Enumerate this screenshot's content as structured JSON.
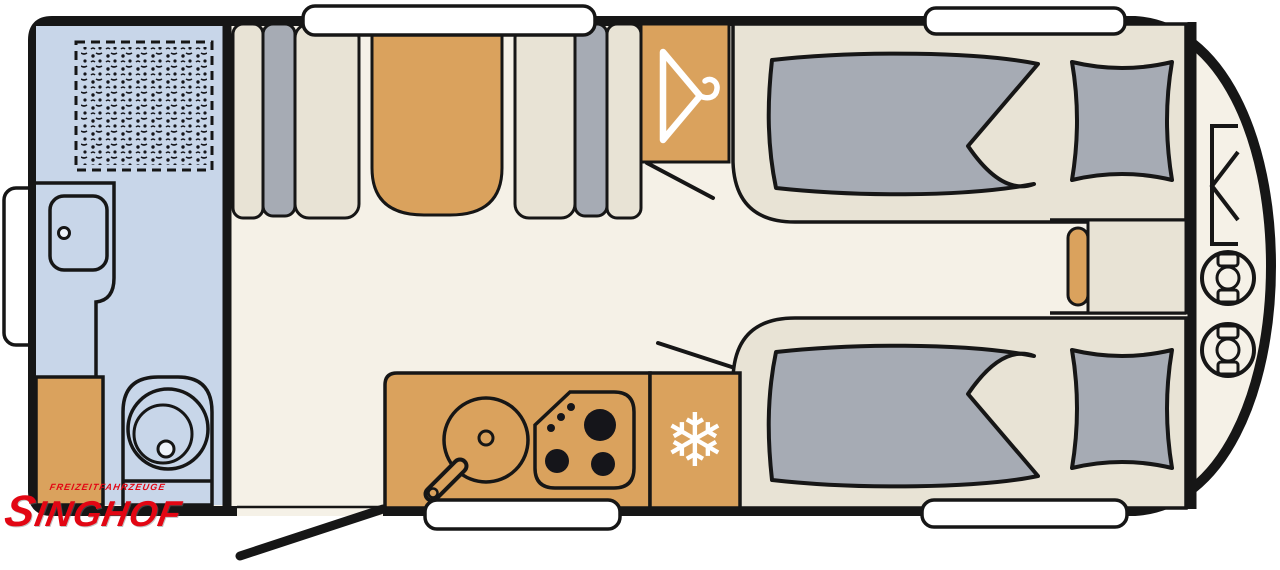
{
  "logo": {
    "title": "SINGHOF",
    "subtitle": "FREIZEITFAHRZEUGE"
  },
  "icons": {
    "snowflake_glyph": "❄",
    "wardrobe": "hanger-icon",
    "fridge": "snowflake-icon",
    "gas_storage": "gas-bottle-icon"
  },
  "colors": {
    "floor-cream": "#f5f1e7",
    "bathroom-blue": "#c8d6e9",
    "furniture-orange": "#daa25d",
    "upholstery-gray": "#a6abb4",
    "platform-beige": "#e8e3d5",
    "wall-black": "#161616",
    "window-white": "#ffffff",
    "logo-red": "#e20613",
    "icon-white": "#ffffff"
  },
  "fixtures": [
    "shower",
    "washbasin",
    "cassette-toilet",
    "bathroom-cabinet",
    "service-flap",
    "dinette-bench-left",
    "dinette-table",
    "dinette-bench-right",
    "wardrobe",
    "kitchen-sink",
    "hob",
    "refrigerator",
    "single-bed-top",
    "single-bed-bottom",
    "bedside-chest",
    "gas-locker",
    "gas-bottles",
    "entry-door",
    "window-top-dinette",
    "window-top-bed",
    "window-bottom-kitchen",
    "window-bottom-bed"
  ]
}
